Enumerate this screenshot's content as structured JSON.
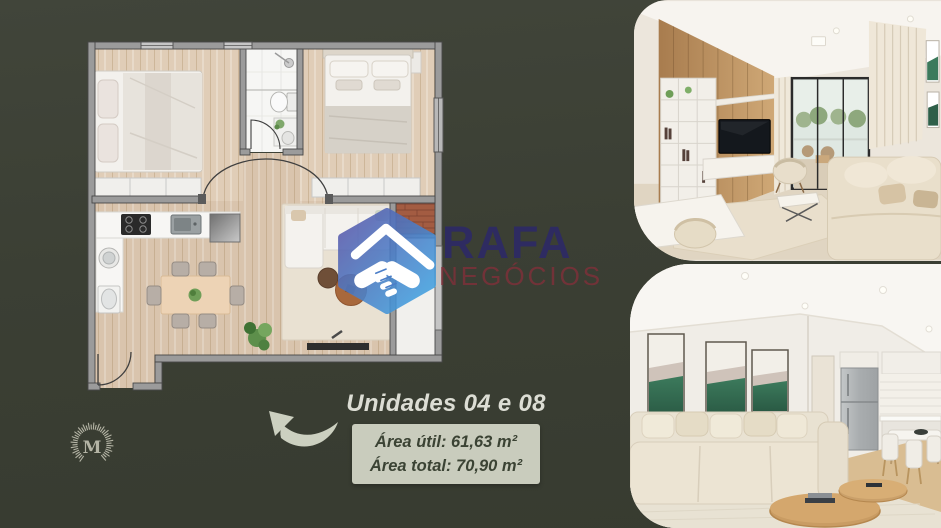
{
  "page": {
    "background_color": "#3b4035"
  },
  "watermark": {
    "brand": "RAFA",
    "subtitle": "NEGÓCIOS",
    "brand_color": "#2d2a64",
    "subtitle_color": "#82303a",
    "icon": "handshake-roof-icon",
    "icon_blue": "#49a0dd"
  },
  "unit_info": {
    "title": "Unidades 04 e 08",
    "area_util": "Área útil: 61,63 m²",
    "area_total": "Área total: 70,90 m²",
    "box_bg": "#c9ccbd",
    "text_color": "#3b4334"
  },
  "monogram": {
    "letter": "M",
    "color": "#b4b4a5"
  },
  "floor_plan": {
    "wall_color": "#9b9b9b",
    "wood_floor_color": "#d9c4ad",
    "bathroom_floor_color": "#f6f6f4",
    "rug_color": "#e9e1d2",
    "brick_color": "#a35c42"
  },
  "photos": {
    "top": "living-room-with-tv-panel-render",
    "bottom": "living-room-and-kitchen-render"
  }
}
